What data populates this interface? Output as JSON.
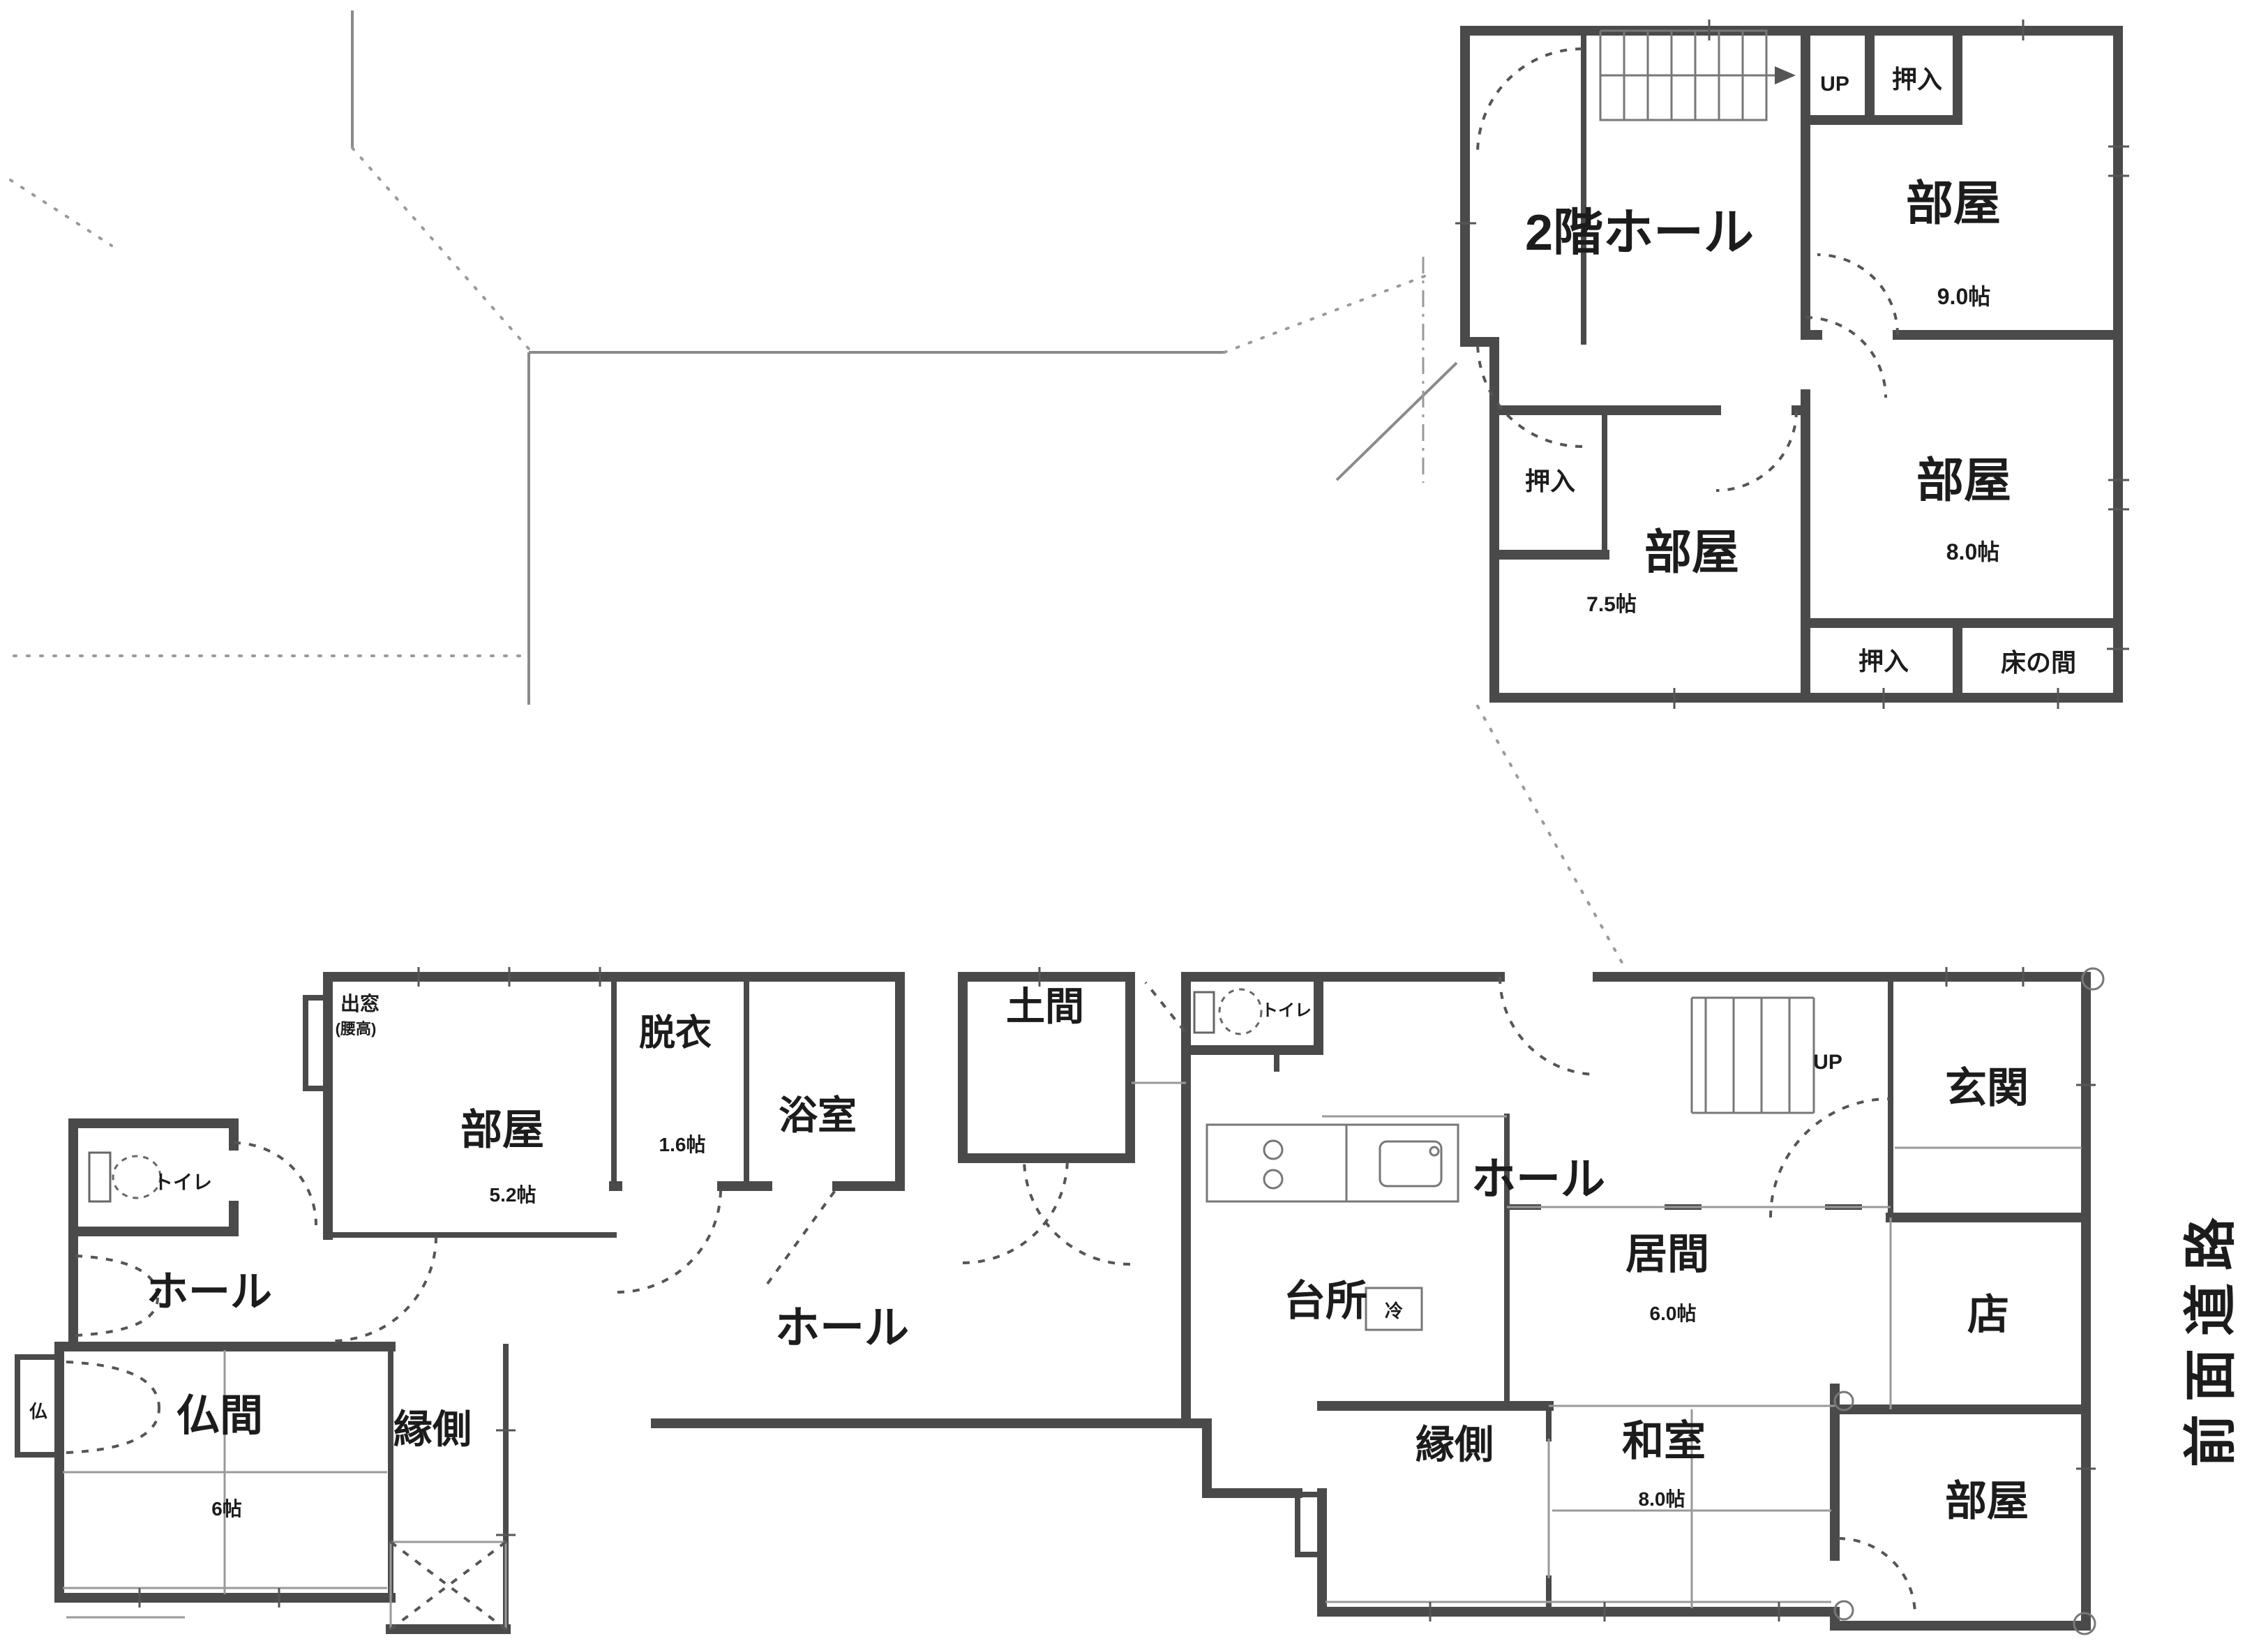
{
  "colors": {
    "wall": "#4a4a4a",
    "text": "#1c1c1c",
    "background": "#ffffff"
  },
  "site": {
    "road_label": "前面道路"
  },
  "floor2": {
    "hall": "2階ホール",
    "up": "UP",
    "closet_top": "押入",
    "closet_west": "押入",
    "closet_south": "押入",
    "tokonoma": "床の間",
    "room_ne": {
      "label": "部屋",
      "size": "9.0帖"
    },
    "room_e": {
      "label": "部屋",
      "size": "8.0帖"
    },
    "room_sw": {
      "label": "部屋",
      "size": "7.5帖"
    }
  },
  "floor1": {
    "bay_window": "出窓",
    "bay_window_note": "(腰高)",
    "room_nw": {
      "label": "部屋",
      "size": "5.2帖"
    },
    "datsui": {
      "label": "脱衣",
      "size": "1.6帖"
    },
    "bath": "浴室",
    "doma": "土間",
    "toilet_left": "トイレ",
    "toilet_mid": "トイレ",
    "hall_left": "ホール",
    "hall_center": "ホール",
    "hall_right": "ホール",
    "butsuma": {
      "label": "仏間",
      "size": "6帖"
    },
    "butsudan": "仏",
    "engawa_left": "縁側",
    "engawa_right": "縁側",
    "kitchen": "台所",
    "fridge": "冷",
    "ima": {
      "label": "居間",
      "size": "6.0帖"
    },
    "genkan": "玄関",
    "shop": "店",
    "washitsu": {
      "label": "和室",
      "size": "8.0帖"
    },
    "room_se": "部屋",
    "up": "UP"
  }
}
